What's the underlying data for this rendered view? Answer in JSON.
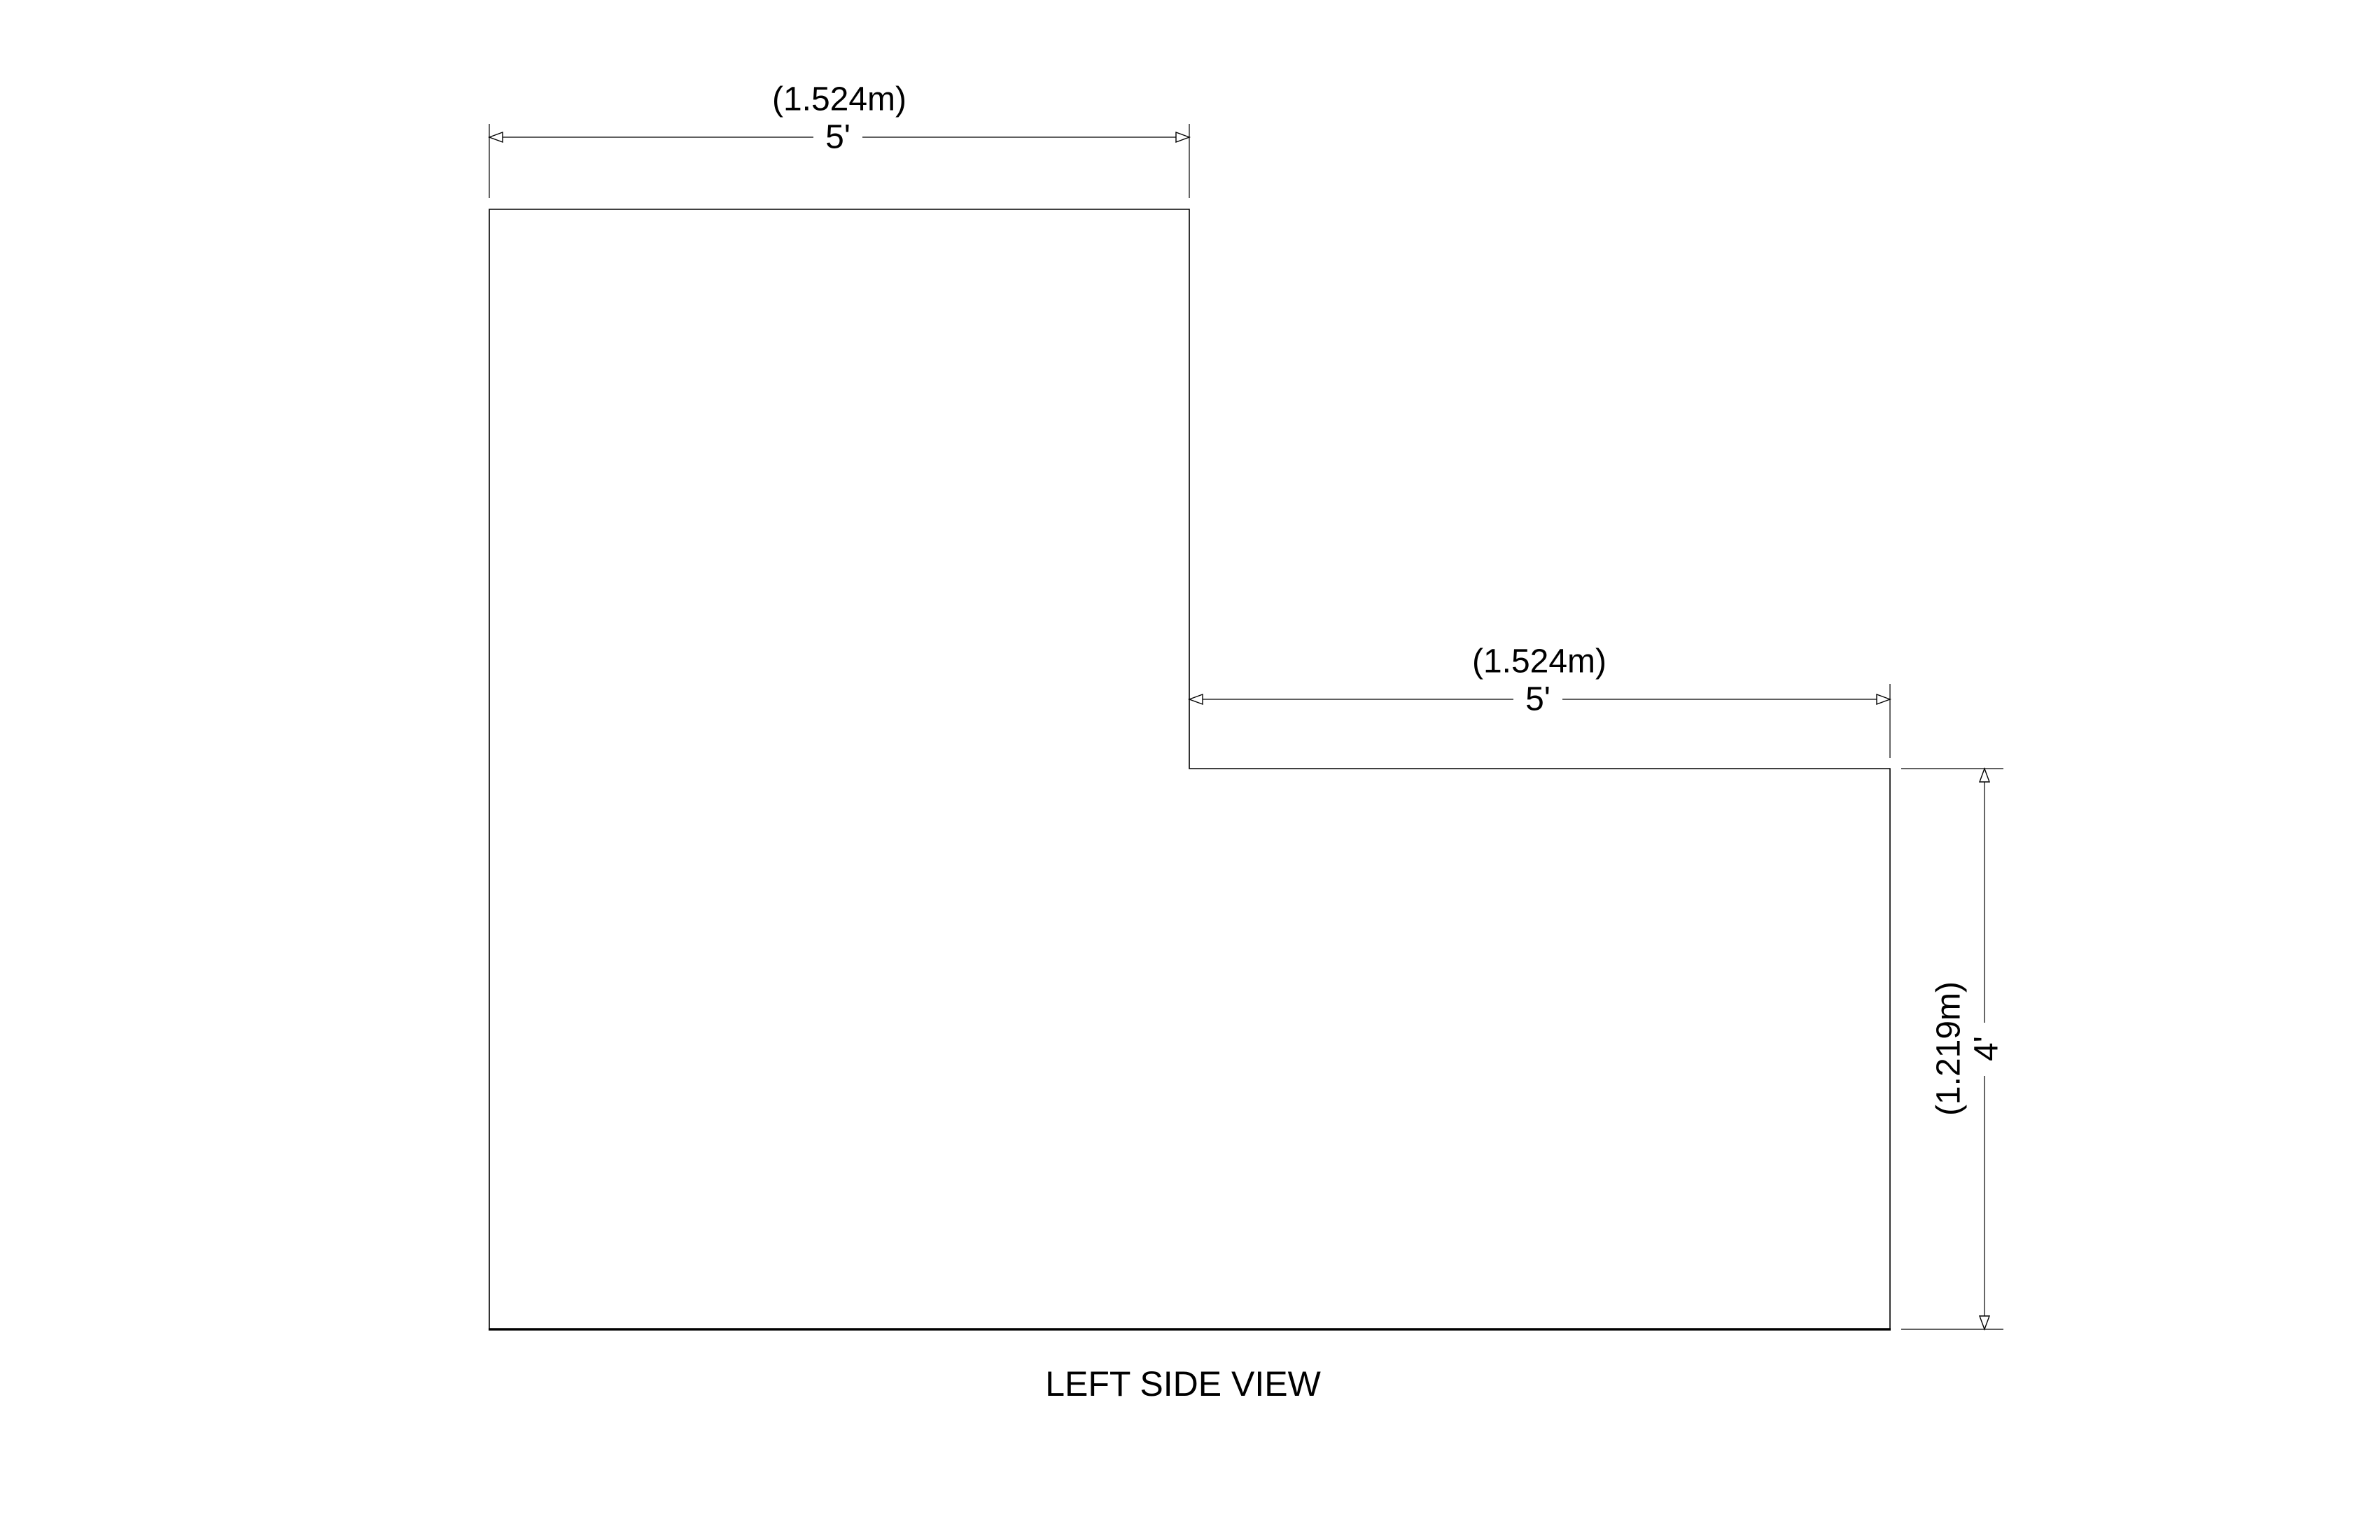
{
  "view": {
    "title": "LEFT SIDE VIEW"
  },
  "dimensions": {
    "top_width": {
      "metric": "(1.524m)",
      "imperial": "5'"
    },
    "step_width": {
      "metric": "(1.524m)",
      "imperial": "5'"
    },
    "right_height": {
      "metric": "(1.219m)",
      "imperial": "4'"
    }
  },
  "colors": {
    "line": "#000000",
    "background": "#ffffff"
  }
}
